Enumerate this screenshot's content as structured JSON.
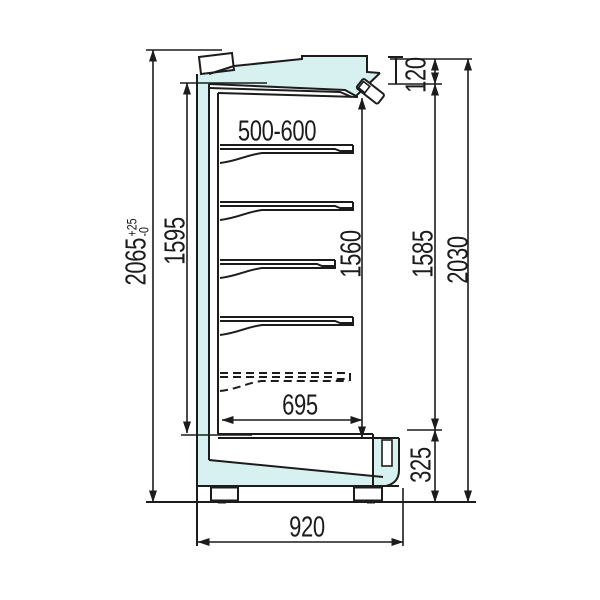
{
  "dimensions": {
    "overall_height": {
      "value": "2065",
      "tol_plus": "+25",
      "tol_minus": "-0"
    },
    "inner_back_height": {
      "value": "1595"
    },
    "interior_height": {
      "value": "1560"
    },
    "front_height": {
      "value": "1585"
    },
    "body_height": {
      "value": "2030"
    },
    "canopy_height": {
      "value": "120"
    },
    "base_height": {
      "value": "325"
    },
    "shelf_pitch_range": {
      "value": "500-600"
    },
    "inner_depth": {
      "value": "695"
    },
    "overall_depth": {
      "value": "920"
    }
  },
  "colors": {
    "line": "#1c1c1c",
    "panel_fill": "#d7f1f0",
    "background": "#ffffff"
  }
}
